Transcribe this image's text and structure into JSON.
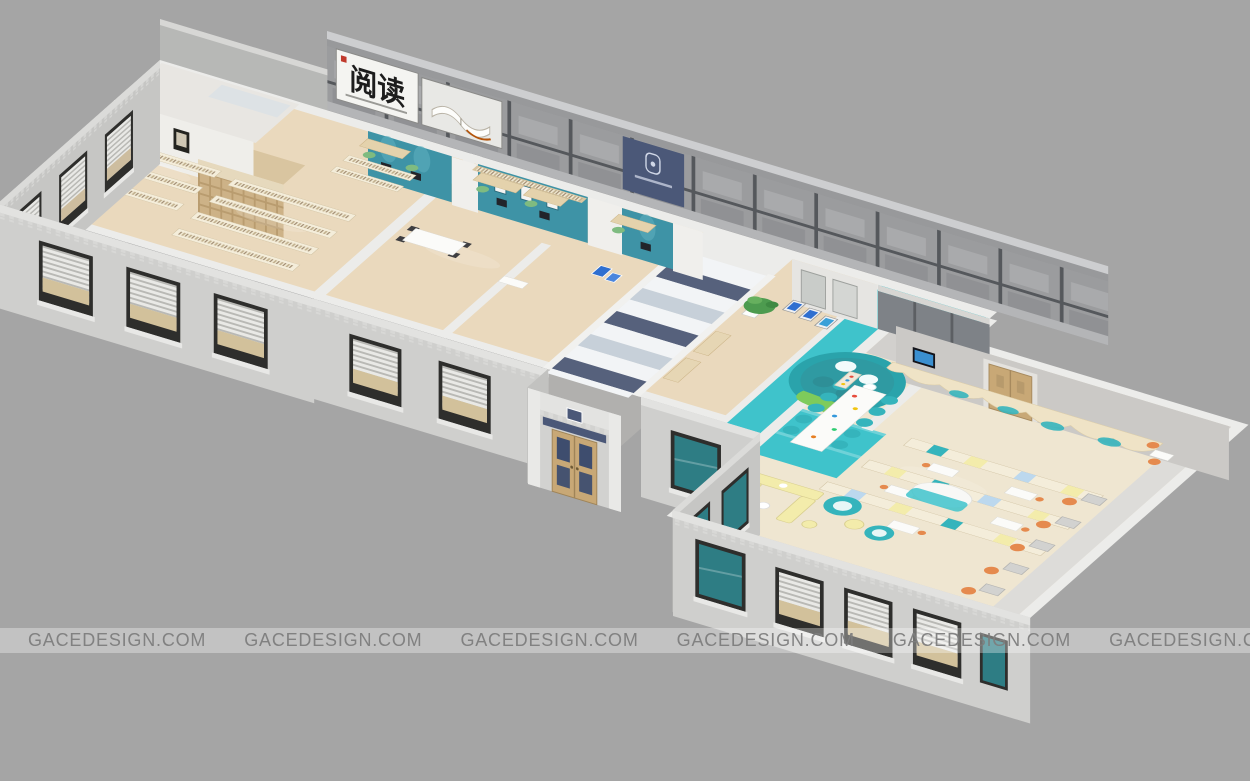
{
  "page": {
    "width_px": 1250,
    "height_px": 781,
    "background_color": "#a5a5a5"
  },
  "watermark": {
    "text": "GACEDESIGN.COM",
    "repeat_count": 8,
    "band_color": "rgba(255,255,255,0.32)",
    "text_color": "#7d7d7d"
  },
  "signage": {
    "facade_calligraphy_sign": "阅读"
  },
  "depicted_elements": [
    "calligraphy-sign",
    "open-book-mural",
    "brand-logo-panel",
    "clerestory-glass-facade",
    "reading-room-left-wing",
    "bookshelf-rows",
    "computer-desks",
    "grand-staircase",
    "entrance-portico",
    "lobby-plant",
    "info-kiosks",
    "sunken-reading-pit",
    "children-reading-wing",
    "wavy-bookshelf",
    "long-reading-table",
    "round-poufs",
    "yellow-sofa",
    "orange-study-chairs",
    "windows-with-blinds",
    "teal-glass-windows"
  ],
  "palette": {
    "background": "#a5a5a5",
    "teal_floor": "#3fc3cb",
    "teal_wall": "#3e93a6",
    "navy": "#4b5878",
    "stair_navy": "#56617c",
    "stair_white": "#f2f4f6",
    "stair_light": "#c7d0d9",
    "wood_floor": "#ead9bd",
    "wood_floor_children": "#efe6d1",
    "shelf_wood": "#d9c5a0",
    "accent_yellow": "#f3ecab",
    "chair_teal": "#35b4bc",
    "chair_green": "#7fbb80",
    "chair_orange": "#e58a4e",
    "sofa_green": "#7ecb5b",
    "plant": "#4d9b4f",
    "door_wood": "#c8a876",
    "glass_teal": "#2e7d84"
  }
}
